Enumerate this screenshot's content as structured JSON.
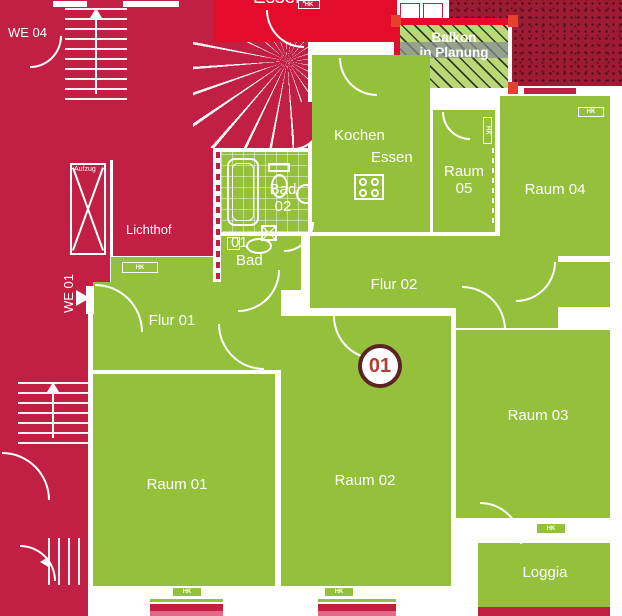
{
  "colors": {
    "apartment_green": "#94c03c",
    "neighbor_red": "#c11f44",
    "highlight_red": "#e30c2d",
    "dark_red_texture": "#9d1b33",
    "balcony_green": "#b9d877",
    "sill_pink": "#e26a88",
    "badge_border": "#5b2423",
    "badge_text": "#b23f35"
  },
  "unit": {
    "badge": "01",
    "we01": "WE 01",
    "we04": "WE 04"
  },
  "rooms": {
    "kochen": {
      "line1": "Kochen",
      "line2": "Essen"
    },
    "raum05": {
      "line1": "Raum",
      "line2": "05"
    },
    "raum04": {
      "label": "Raum 04"
    },
    "flur02": {
      "label": "Flur 02"
    },
    "flur01": {
      "label": "Flur 01"
    },
    "raum01": {
      "label": "Raum 01"
    },
    "raum02": {
      "label": "Raum 02"
    },
    "raum03": {
      "label": "Raum 03"
    },
    "loggia": {
      "label": "Loggia"
    },
    "bad02": {
      "line1": "Bad",
      "line2": "02"
    },
    "bad01": {
      "line1": "01",
      "line2": "Bad"
    }
  },
  "common": {
    "lichthof": "Lichthof",
    "aufzug": "Aufzug",
    "essen_neighbor": "Essen"
  },
  "balcony": {
    "line1": "Balkon",
    "line2": "in Planung"
  },
  "radiator": "HK"
}
